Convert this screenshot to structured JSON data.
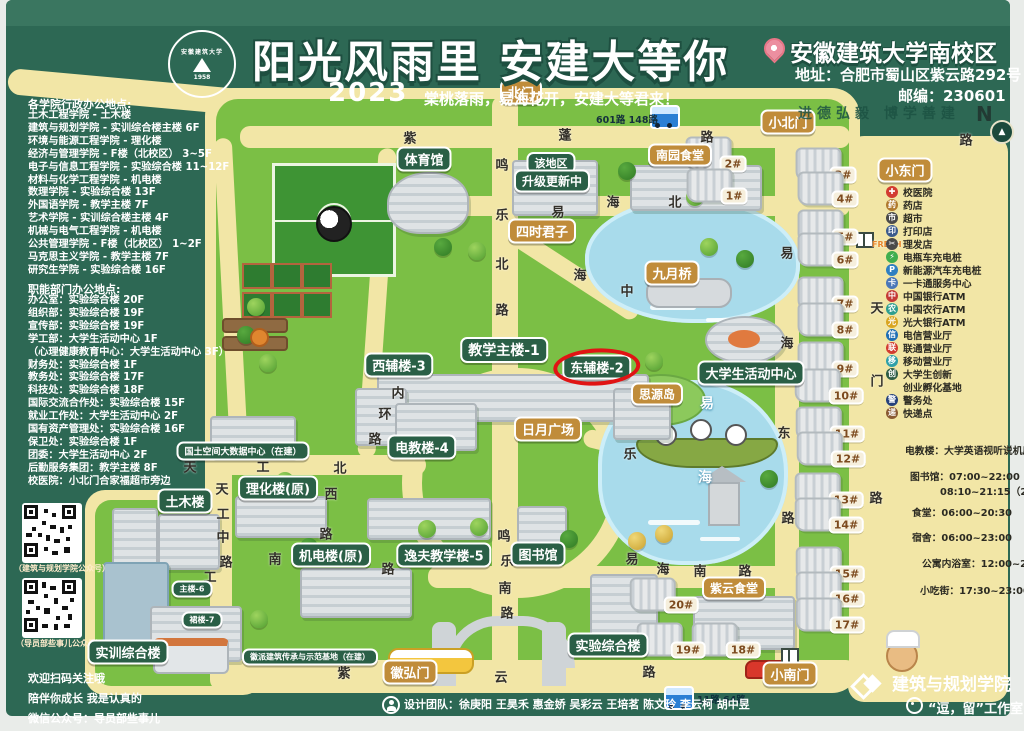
{
  "poster": {
    "title": "阳光风雨里 安建大等你",
    "year": "2023",
    "subtitle": "棠桃落雨，易海花开，安建大等君来！",
    "seal_name": "安徽建筑大学",
    "seal_year": "1958",
    "campus": "安徽建筑大学南校区",
    "address": "地址：合肥市蜀山区紫云路292号",
    "zip": "邮编：230601",
    "motto": "进德弘毅 博学善建",
    "compass": "N"
  },
  "sidebar": {
    "college_title": "各学院行政办公地点:",
    "college_lines": [
      "土木工程学院 - 土木楼",
      "建筑与规划学院 - 实训综合楼主楼 6F",
      "环境与能源工程学院 - 理化楼",
      "经济与管理学院 - F楼（北校区） 3~5F",
      "电子与信息工程学院 - 实验综合楼 11~12F",
      "材料与化学工程学院 - 机电楼",
      "数理学院 - 实验综合楼 13F",
      "外国语学院 - 教学主楼 7F",
      "艺术学院 - 实训综合楼主楼 4F",
      "机械与电气工程学院 - 机电楼",
      "公共管理学院 - F楼（北校区） 1~2F",
      "马克思主义学院 - 教学主楼 7F",
      "研究生学院 - 实验综合楼 16F"
    ],
    "dept_title": "职能部门办公地点:",
    "dept_lines": [
      "办公室：实验综合楼 20F",
      "组织部：实验综合楼 19F",
      "宣传部：实验综合楼 19F",
      "学工部：大学生活动中心 1F",
      "（心理健康教育中心：大学生活动中心 3F）",
      "财务处：实验综合楼 1F",
      "教务处：实验综合楼 17F",
      "科技处：实验综合楼 18F",
      "国际交流合作处：实验综合楼 15F",
      "就业工作处：大学生活动中心 2F",
      "国有资产管理处：实验综合楼 16F",
      "保卫处：实验综合楼 1F",
      "团委：大学生活动中心 2F",
      "后勤服务集团：教学主楼 8F",
      "校医院：小北门合家福超市旁边"
    ],
    "qr1_caption": "（建筑与规划学院公众号）",
    "qr2_caption": "（导员部些事儿公众号）",
    "follow_lines": [
      "欢迎扫码关注哦",
      "陪伴你成长 我是认真的",
      "微信公众号：导员部些事儿"
    ]
  },
  "map": {
    "green_labels": [
      {
        "text": "体育馆",
        "x": 424,
        "y": 159
      },
      {
        "text": "该地区",
        "x": 551,
        "y": 163,
        "fs": 11
      },
      {
        "text": "升级更新中",
        "x": 552,
        "y": 181,
        "fs": 12
      },
      {
        "text": "教学主楼-1",
        "x": 504,
        "y": 350,
        "fs": 14
      },
      {
        "text": "西辅楼-3",
        "x": 399,
        "y": 365
      },
      {
        "text": "东辅楼-2",
        "x": 597,
        "y": 367,
        "cls": "circled"
      },
      {
        "text": "电教楼-4",
        "x": 422,
        "y": 447
      },
      {
        "text": "大学生活动中心",
        "x": 751,
        "y": 373
      },
      {
        "text": "国土空间大数据中心（在建）",
        "x": 243,
        "y": 451,
        "fs": 9
      },
      {
        "text": "理化楼(原)",
        "x": 278,
        "y": 488
      },
      {
        "text": "土木楼",
        "x": 185,
        "y": 501
      },
      {
        "text": "机电楼(原)",
        "x": 331,
        "y": 555
      },
      {
        "text": "逸夫教学楼-5",
        "x": 444,
        "y": 555
      },
      {
        "text": "图书馆",
        "x": 538,
        "y": 554
      },
      {
        "text": "主楼-6",
        "x": 192,
        "y": 589,
        "fs": 8
      },
      {
        "text": "裙楼-7",
        "x": 202,
        "y": 620,
        "fs": 8
      },
      {
        "text": "实训综合楼",
        "x": 128,
        "y": 652
      },
      {
        "text": "徽派建筑传承与示范基地（在建）",
        "x": 310,
        "y": 657,
        "fs": 8
      },
      {
        "text": "实验综合楼",
        "x": 608,
        "y": 645
      }
    ],
    "tan_labels": [
      {
        "text": "北门",
        "x": 521,
        "y": 92
      },
      {
        "text": "小北门",
        "x": 788,
        "y": 122
      },
      {
        "text": "小东门",
        "x": 905,
        "y": 170
      },
      {
        "text": "南园食堂",
        "x": 680,
        "y": 155,
        "fs": 12
      },
      {
        "text": "四时君子",
        "x": 542,
        "y": 231
      },
      {
        "text": "九月桥",
        "x": 672,
        "y": 273
      },
      {
        "text": "思源岛",
        "x": 657,
        "y": 394,
        "fs": 12
      },
      {
        "text": "日月广场",
        "x": 548,
        "y": 429
      },
      {
        "text": "紫云食堂",
        "x": 734,
        "y": 588,
        "fs": 12
      },
      {
        "text": "徽弘门",
        "x": 410,
        "y": 672
      },
      {
        "text": "小南门",
        "x": 790,
        "y": 674
      }
    ],
    "dorms": [
      {
        "num": "2#",
        "x": 733,
        "y": 162
      },
      {
        "num": "1#",
        "x": 734,
        "y": 194
      },
      {
        "num": "3#",
        "x": 843,
        "y": 173
      },
      {
        "num": "4#",
        "x": 845,
        "y": 197
      },
      {
        "num": "5#",
        "x": 845,
        "y": 235
      },
      {
        "num": "6#",
        "x": 845,
        "y": 258
      },
      {
        "num": "7#",
        "x": 845,
        "y": 302
      },
      {
        "num": "8#",
        "x": 845,
        "y": 328
      },
      {
        "num": "9#",
        "x": 845,
        "y": 367
      },
      {
        "num": "10#",
        "x": 846,
        "y": 394
      },
      {
        "num": "11#",
        "x": 847,
        "y": 432
      },
      {
        "num": "12#",
        "x": 848,
        "y": 457
      },
      {
        "num": "13#",
        "x": 846,
        "y": 498
      },
      {
        "num": "14#",
        "x": 846,
        "y": 523
      },
      {
        "num": "15#",
        "x": 847,
        "y": 572
      },
      {
        "num": "16#",
        "x": 847,
        "y": 597
      },
      {
        "num": "17#",
        "x": 847,
        "y": 623
      },
      {
        "num": "18#",
        "x": 743,
        "y": 648
      },
      {
        "num": "19#",
        "x": 688,
        "y": 648
      },
      {
        "num": "20#",
        "x": 681,
        "y": 603
      }
    ],
    "streets": [
      {
        "ch": "紫",
        "x": 410,
        "y": 137
      },
      {
        "ch": "蓬",
        "x": 565,
        "y": 134
      },
      {
        "ch": "路",
        "x": 707,
        "y": 136
      },
      {
        "ch": "路",
        "x": 966,
        "y": 139
      },
      {
        "ch": "鸣",
        "x": 502,
        "y": 164
      },
      {
        "ch": "乐",
        "x": 502,
        "y": 214
      },
      {
        "ch": "北",
        "x": 502,
        "y": 263
      },
      {
        "ch": "路",
        "x": 502,
        "y": 309
      },
      {
        "ch": "易",
        "x": 558,
        "y": 211
      },
      {
        "ch": "海",
        "x": 613,
        "y": 201
      },
      {
        "ch": "北",
        "x": 675,
        "y": 201
      },
      {
        "ch": "海",
        "x": 580,
        "y": 274
      },
      {
        "ch": "中",
        "x": 627,
        "y": 290
      },
      {
        "ch": "内",
        "x": 398,
        "y": 392
      },
      {
        "ch": "环",
        "x": 385,
        "y": 413
      },
      {
        "ch": "路",
        "x": 375,
        "y": 438
      },
      {
        "ch": "天",
        "x": 190,
        "y": 466
      },
      {
        "ch": "工",
        "x": 263,
        "y": 466
      },
      {
        "ch": "北",
        "x": 340,
        "y": 467
      },
      {
        "ch": "西",
        "x": 331,
        "y": 493
      },
      {
        "ch": "路",
        "x": 326,
        "y": 533
      },
      {
        "ch": "天",
        "x": 222,
        "y": 488
      },
      {
        "ch": "工",
        "x": 223,
        "y": 513
      },
      {
        "ch": "中",
        "x": 223,
        "y": 536
      },
      {
        "ch": "路",
        "x": 226,
        "y": 561
      },
      {
        "ch": "南",
        "x": 275,
        "y": 558
      },
      {
        "ch": "工",
        "x": 210,
        "y": 576
      },
      {
        "ch": "路",
        "x": 388,
        "y": 568
      },
      {
        "ch": "鸣",
        "x": 504,
        "y": 535
      },
      {
        "ch": "乐",
        "x": 507,
        "y": 560
      },
      {
        "ch": "南",
        "x": 505,
        "y": 587
      },
      {
        "ch": "路",
        "x": 507,
        "y": 612
      },
      {
        "ch": "易",
        "x": 787,
        "y": 252
      },
      {
        "ch": "海",
        "x": 787,
        "y": 342
      },
      {
        "ch": "东",
        "x": 784,
        "y": 432
      },
      {
        "ch": "路",
        "x": 788,
        "y": 517
      },
      {
        "ch": "易",
        "x": 632,
        "y": 558
      },
      {
        "ch": "海",
        "x": 663,
        "y": 568
      },
      {
        "ch": "南",
        "x": 700,
        "y": 570
      },
      {
        "ch": "路",
        "x": 745,
        "y": 570
      },
      {
        "ch": "紫",
        "x": 344,
        "y": 672
      },
      {
        "ch": "云",
        "x": 501,
        "y": 676
      },
      {
        "ch": "路",
        "x": 649,
        "y": 671
      },
      {
        "ch": "天",
        "x": 877,
        "y": 307
      },
      {
        "ch": "门",
        "x": 877,
        "y": 380
      },
      {
        "ch": "路",
        "x": 876,
        "y": 497
      },
      {
        "ch": "乐",
        "x": 630,
        "y": 453
      },
      {
        "ch": "易",
        "x": 707,
        "y": 403,
        "cls": "water"
      },
      {
        "ch": "海",
        "x": 705,
        "y": 477,
        "cls": "water"
      }
    ],
    "bus_top": "601路 148路",
    "bus_bottom": "11路 64路",
    "fresh_sign": "FRESH"
  },
  "legend": {
    "services": [
      {
        "glyph": "✚",
        "color": "#d23c31",
        "label": "校医院"
      },
      {
        "glyph": "药",
        "color": "#b07a2f",
        "label": "药店"
      },
      {
        "glyph": "市",
        "color": "#4a4a4a",
        "label": "超市"
      },
      {
        "glyph": "印",
        "color": "#3a5a8c",
        "label": "打印店"
      },
      {
        "glyph": "✂",
        "color": "#4a4a4a",
        "label": "理发店"
      },
      {
        "glyph": "⚡",
        "color": "#3fae4e",
        "label": "电瓶车充电桩"
      },
      {
        "glyph": "P",
        "color": "#2f7fc1",
        "label": "新能源汽车充电桩"
      },
      {
        "glyph": "卡",
        "color": "#4a77b8",
        "label": "一卡通服务中心"
      },
      {
        "glyph": "中",
        "color": "#c43a36",
        "label": "中国银行ATM"
      },
      {
        "glyph": "农",
        "color": "#2e9e8f",
        "label": "中国农行ATM"
      },
      {
        "glyph": "光",
        "color": "#d9a520",
        "label": "光大银行ATM"
      },
      {
        "glyph": "信",
        "color": "#1f6fb4",
        "label": "电信营业厅"
      },
      {
        "glyph": "联",
        "color": "#d23c31",
        "label": "联通营业厅"
      },
      {
        "glyph": "移",
        "color": "#2ea0a8",
        "label": "移动营业厅"
      },
      {
        "glyph": "创",
        "color": "#2f5d46",
        "label": "大学生创新"
      },
      {
        "glyph": "",
        "color": "",
        "label": "创业孵化基地"
      },
      {
        "glyph": "警",
        "color": "#27427c",
        "label": "警务处"
      },
      {
        "glyph": "递",
        "color": "#8a5a33",
        "label": "快递点"
      }
    ],
    "hours": [
      {
        "text": "电教楼：大学英语视听说机房 5F",
        "x": 905,
        "y": 450
      },
      {
        "text": "图书馆：07:00~22:00（1F）",
        "x": 910,
        "y": 476
      },
      {
        "text": "08:10~21:15（2-5F）",
        "x": 940,
        "y": 491
      },
      {
        "text": "食堂：06:00~20:30",
        "x": 912,
        "y": 512
      },
      {
        "text": "宿舍：06:00~23:00",
        "x": 912,
        "y": 537
      },
      {
        "text": "公寓内浴室：12:00~24:00",
        "x": 922,
        "y": 563
      },
      {
        "text": "小吃街：17:30~23:00",
        "x": 920,
        "y": 590
      }
    ]
  },
  "footer": {
    "credits": "设计团队：徐庚阳 王昊禾 惠金娇 吴彩云 王培茗 陈文玲 李云柯 胡中昱",
    "studio_college": "建筑与规划学院",
    "studio_name": "“逗，留”工作室"
  }
}
